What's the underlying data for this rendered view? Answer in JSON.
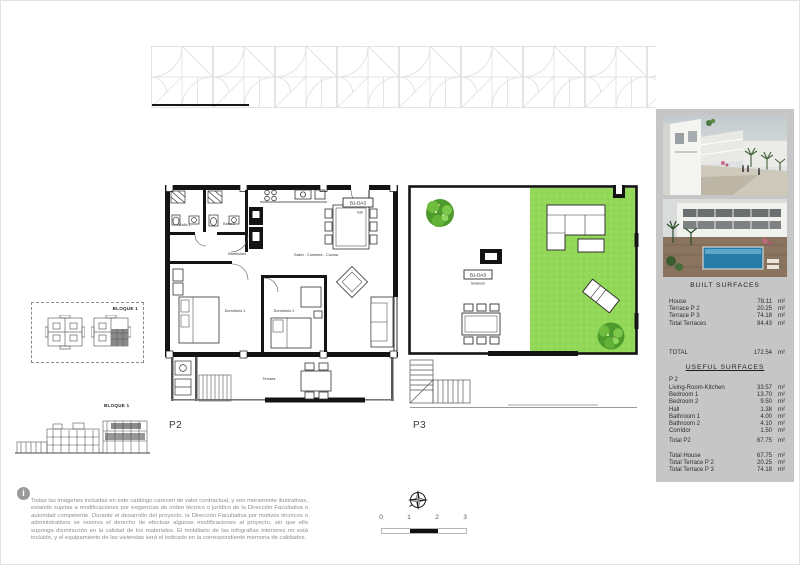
{
  "plans": {
    "p2": {
      "label": "P2",
      "unit_code": "B1-DA3",
      "unit_sub": "hall",
      "rooms": {
        "bano1": "Baño 1",
        "bano2": "Baño 2",
        "distribuidor": "Distribuidor",
        "salon": "Salón - Comedor - Cocina",
        "dorm1": "Dormitorio 1",
        "dorm2": "Dormitorio 2",
        "terraza": "Terraza"
      }
    },
    "p3": {
      "label": "P3",
      "unit_code": "B1-DA3",
      "unit_sub": "Solarium"
    }
  },
  "site_key": {
    "label": "BLOQUE 1"
  },
  "elevation": {
    "label": "BLOQUE 1"
  },
  "sidebar": {
    "built": {
      "title": "BUILT  SURFACES",
      "rows": [
        {
          "label": "House",
          "value": "78.11",
          "unit": "m²"
        },
        {
          "label": "Terrace  P 2",
          "value": "20.25",
          "unit": "m²"
        },
        {
          "label": "Terrace  P 3",
          "value": "74.18",
          "unit": "m²"
        },
        {
          "label": "Total Terraces",
          "value": "94.43",
          "unit": "m²"
        }
      ],
      "total": {
        "label": "TOTAL",
        "value": "172.54",
        "unit": "m²"
      }
    },
    "useful": {
      "title": "USEFUL  SURFACES",
      "floor_label": "P 2",
      "rows": [
        {
          "label": "Living-Room-Kitchen",
          "value": "33.57",
          "unit": "m²"
        },
        {
          "label": "Bedroom 1",
          "value": "13.70",
          "unit": "m²"
        },
        {
          "label": "Bedroom 2",
          "value": "9.50",
          "unit": "m²"
        },
        {
          "label": "Hall",
          "value": "1.38",
          "unit": "m²"
        },
        {
          "label": "Bathroom 1",
          "value": "4.00",
          "unit": "m²"
        },
        {
          "label": "Bathroom 2",
          "value": "4.10",
          "unit": "m²"
        },
        {
          "label": "Corridor",
          "value": "1.50",
          "unit": "m²"
        }
      ],
      "subtotal": {
        "label": "Total  P2",
        "value": "67.75",
        "unit": "m²"
      },
      "totals": [
        {
          "label": "Total  House",
          "value": "67.75",
          "unit": "m²"
        },
        {
          "label": "Total  Terrace  P 2",
          "value": "20.25",
          "unit": "m²"
        },
        {
          "label": "Total  Terrace  P 3",
          "value": "74.18",
          "unit": "m²"
        }
      ]
    }
  },
  "footer": {
    "info_icon": "i",
    "disclaimer": "Todas las imágenes incluidas en este catálogo carecen de valor contractual, y son meramente ilustrativas, estando sujetas a modificaciones por exigencias de orden técnico o jurídico de la Dirección Facultativa o autoridad competente. Durante el desarrollo del proyecto, la Dirección Facultativa por motivos técnicos o administrativos se reserva el derecho de efectuar algunas modificaciones al proyecto, sin que ello suponga disminución en la calidad de los materiales. El mobiliario de las infografías interiores no está incluido, y el equipamiento de las viviendas será el indicado en la correspondiente memoria de calidades.",
    "scale_ticks": [
      "0",
      "1",
      "2",
      "3"
    ]
  },
  "colors": {
    "grass": "#93d859",
    "panel": "#c6c6c6",
    "pool": "#2a7ca8"
  }
}
